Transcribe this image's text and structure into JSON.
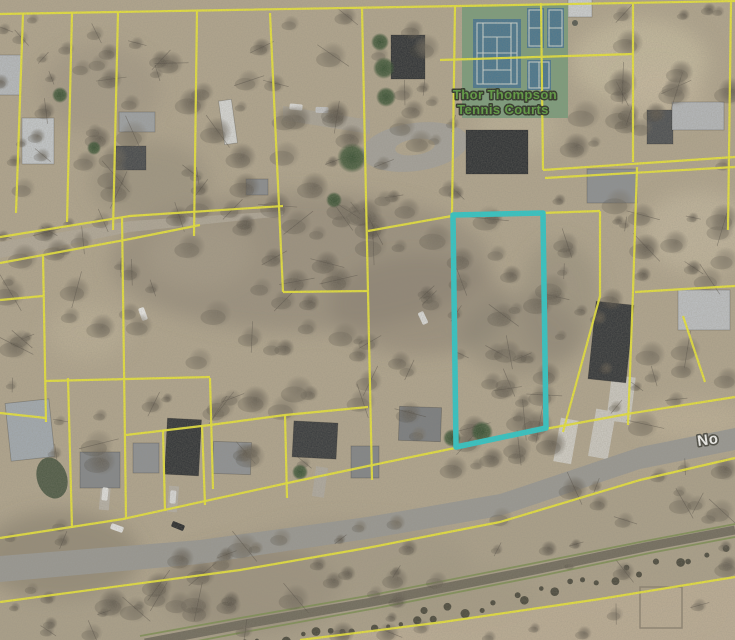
{
  "map": {
    "canvas": {
      "width": 735,
      "height": 640
    },
    "palette": {
      "ground": "#b3a78f",
      "parcel_line": "#eeea35",
      "highlight": "#2acbcb",
      "road": "#9b9a95",
      "rail_green": "#7d9052",
      "rail_bed": "#6c6659",
      "tennis_surface": "#7c9e7c",
      "tennis_court_blue": "#47768f",
      "tennis_label_fill": "#5a9e3c",
      "tennis_label_outline": "#272f21",
      "street_label_fill": "#fbfbf9",
      "street_label_outline": "#46463f"
    },
    "labels": {
      "tennis_facility": {
        "line1": "Thor Thompson",
        "line2": "Tennis Courts"
      },
      "street": {
        "text": "No"
      }
    },
    "highlighted_parcel": {
      "points": "453,215 543,213 546,428 456,447",
      "color": "#2acbcb",
      "width": 5.5
    },
    "parcel_lines": {
      "color": "#eeea35",
      "width": 2.2,
      "segments": [
        "0,14 230,10 460,6 735,1",
        "23,14 16,213",
        "72,13 67,222",
        "118,12 113,230",
        "197,11 194,236",
        "270,13 283,292",
        "362,8 368,292 372,480",
        "455,7 452,213",
        "541,3 543,170",
        "633,4 633,162",
        "731,2 728,230",
        "440,60 633,54",
        "543,170 735,157",
        "545,178 735,167",
        "368,231 452,216 600,211",
        "600,211 600,296 563,432",
        "283,292 368,291",
        "635,292 735,286",
        "637,167 633,292 628,425",
        "683,316 705,382",
        "0,237 130,216 283,206",
        "0,263 130,239 200,225",
        "43,256 46,422",
        "0,413 46,418",
        "68,378 72,528",
        "46,381 210,377",
        "122,217 126,519",
        "210,378 213,489",
        "163,430 165,511",
        "202,425 205,505",
        "285,415 287,498",
        "126,435 210,425 285,415 368,407",
        "0,300 43,296",
        "0,538 123,519 283,484 368,466 455,448 545,429 633,413 735,397",
        "0,602 240,570 367,548 500,522 640,480 735,458",
        "300,640 443,622 600,599 735,577"
      ]
    },
    "roads": {
      "main_polygon": "0,556 200,540 367,517 500,494 640,447 735,428 735,450 640,469 500,516 367,539 200,564 0,582",
      "fill": "#9b9a95",
      "paths": [
        {
          "points": "0,242 130,221 283,211 283,216 130,232 0,258",
          "fill": "#b4ab9c",
          "op": 0.85
        },
        {
          "points": "283,106 370,120 370,134 283,120",
          "fill": "#a9a59d",
          "op": 0.7
        }
      ],
      "loop": {
        "cx": 415,
        "cy": 147,
        "rx": 54,
        "ry": 24,
        "rot": -8,
        "fill": "#a6a39c",
        "island": {
          "rx": 20,
          "ry": 8,
          "fill": "#b3a78f"
        }
      },
      "pads": [
        {
          "x": 566,
          "y": 441,
          "w": 18,
          "h": 44,
          "rot": 10,
          "fill": "#d4d1c9"
        },
        {
          "x": 602,
          "y": 434,
          "w": 20,
          "h": 48,
          "rot": 10,
          "fill": "#cfccc4"
        },
        {
          "x": 621,
          "y": 399,
          "w": 24,
          "h": 46,
          "rot": 7,
          "fill": "#cecbc3"
        },
        {
          "x": 105,
          "y": 496,
          "w": 10,
          "h": 28,
          "rot": 5,
          "fill": "#b9b3a8"
        },
        {
          "x": 173,
          "y": 499,
          "w": 10,
          "h": 26,
          "rot": 5,
          "fill": "#b6b0a5"
        },
        {
          "x": 320,
          "y": 482,
          "w": 12,
          "h": 30,
          "rot": 8,
          "fill": "#b2aca1"
        }
      ]
    },
    "railroad": {
      "corridor_polygon": "0,602 240,570 367,548 500,522 640,480 735,458 735,577 600,599 443,622 300,640 0,640",
      "corridor_fill": "#a89d88",
      "field_polygon": "300,640 443,622 600,599 735,577 735,640",
      "field_fill": "#c0b298",
      "bed_points": "145,643 245,624 372,602 535,570 645,547 735,530",
      "green_lines": [
        "140,636 240,618 367,596 530,564 640,542 735,524",
        "150,650 250,631 377,608 540,576 650,553 735,537"
      ],
      "shrub_baseline": "195,655 300,638 420,616 540,592 640,570 735,550",
      "shrub_fill": "#3a382e",
      "fence_square": {
        "x": 640,
        "y": 587,
        "w": 42,
        "h": 41,
        "stroke": "#8a7f6d"
      }
    },
    "tennis_courts": {
      "surface": {
        "x": 462,
        "y": 5,
        "w": 106,
        "h": 113,
        "fill": "#7c9e7c"
      },
      "courts": [
        {
          "x": 473,
          "y": 19,
          "w": 48,
          "h": 69
        },
        {
          "x": 527,
          "y": 8,
          "w": 17,
          "h": 40
        },
        {
          "x": 547,
          "y": 8,
          "w": 17,
          "h": 40
        },
        {
          "x": 527,
          "y": 60,
          "w": 24,
          "h": 30
        }
      ],
      "court_fill": "#47768f",
      "white_rects": [
        {
          "x": 477,
          "y": 23,
          "w": 40,
          "h": 61
        },
        {
          "x": 529,
          "y": 10,
          "w": 13,
          "h": 36
        },
        {
          "x": 549,
          "y": 10,
          "w": 13,
          "h": 36
        },
        {
          "x": 529,
          "y": 62,
          "w": 20,
          "h": 26
        }
      ],
      "white_lines": [
        {
          "x1": 483,
          "y1": 23,
          "x2": 483,
          "y2": 84
        },
        {
          "x1": 511,
          "y1": 23,
          "x2": 511,
          "y2": 84
        },
        {
          "x1": 483,
          "y1": 37,
          "x2": 511,
          "y2": 37
        },
        {
          "x1": 483,
          "y1": 70,
          "x2": 511,
          "y2": 70
        },
        {
          "x1": 497,
          "y1": 37,
          "x2": 497,
          "y2": 70
        },
        {
          "x1": 477,
          "y1": 53,
          "x2": 517,
          "y2": 53
        },
        {
          "x1": 529,
          "y1": 28,
          "x2": 542,
          "y2": 28
        },
        {
          "x1": 549,
          "y1": 28,
          "x2": 562,
          "y2": 28
        },
        {
          "x1": 539,
          "y1": 62,
          "x2": 539,
          "y2": 88
        }
      ]
    },
    "buildings": [
      {
        "x": 10,
        "y": 75,
        "w": 22,
        "h": 40,
        "rot": 0,
        "fill": "#b9bdc1"
      },
      {
        "x": 38,
        "y": 141,
        "w": 32,
        "h": 46,
        "rot": 0,
        "fill": "#c7cbce"
      },
      {
        "x": 137,
        "y": 122,
        "w": 36,
        "h": 20,
        "rot": 0,
        "fill": "#9fa3a6"
      },
      {
        "x": 131,
        "y": 158,
        "w": 30,
        "h": 24,
        "rot": 0,
        "fill": "#45484b"
      },
      {
        "x": 228,
        "y": 122,
        "w": 13,
        "h": 44,
        "rot": -8,
        "fill": "#dadbd9"
      },
      {
        "x": 257,
        "y": 187,
        "w": 22,
        "h": 16,
        "rot": 0,
        "fill": "#8b8e91"
      },
      {
        "x": 408,
        "y": 57,
        "w": 34,
        "h": 44,
        "rot": 0,
        "fill": "#2e3134"
      },
      {
        "x": 497,
        "y": 152,
        "w": 62,
        "h": 44,
        "rot": 0,
        "fill": "#2b2e31"
      },
      {
        "x": 612,
        "y": 186,
        "w": 50,
        "h": 34,
        "rot": 0,
        "fill": "#8e9194"
      },
      {
        "x": 660,
        "y": 127,
        "w": 26,
        "h": 34,
        "rot": 0,
        "fill": "#4b4e51"
      },
      {
        "x": 698,
        "y": 116,
        "w": 52,
        "h": 28,
        "rot": 0,
        "fill": "#b7babd"
      },
      {
        "x": 580,
        "y": 8,
        "w": 24,
        "h": 18,
        "rot": 0,
        "fill": "#cfd2d4"
      },
      {
        "x": 704,
        "y": 310,
        "w": 52,
        "h": 40,
        "rot": 0,
        "fill": "#c0c3c6"
      },
      {
        "x": 611,
        "y": 342,
        "w": 38,
        "h": 78,
        "rot": 6,
        "fill": "#303336"
      },
      {
        "x": 30,
        "y": 430,
        "w": 44,
        "h": 58,
        "rot": -6,
        "fill": "#a4acb3"
      },
      {
        "x": 100,
        "y": 470,
        "w": 40,
        "h": 36,
        "rot": 0,
        "fill": "#85888b"
      },
      {
        "x": 146,
        "y": 458,
        "w": 26,
        "h": 30,
        "rot": 0,
        "fill": "#8f9295"
      },
      {
        "x": 183,
        "y": 447,
        "w": 34,
        "h": 56,
        "rot": 3,
        "fill": "#2e3134"
      },
      {
        "x": 232,
        "y": 458,
        "w": 38,
        "h": 32,
        "rot": 2,
        "fill": "#909396"
      },
      {
        "x": 315,
        "y": 440,
        "w": 44,
        "h": 36,
        "rot": 3,
        "fill": "#35383b"
      },
      {
        "x": 365,
        "y": 462,
        "w": 28,
        "h": 32,
        "rot": 0,
        "fill": "#838689"
      },
      {
        "x": 420,
        "y": 424,
        "w": 42,
        "h": 34,
        "rot": 2,
        "fill": "#7b7e81"
      }
    ],
    "vehicles": [
      {
        "x": 117,
        "y": 528,
        "rot": -70,
        "fill": "#e8e8e6"
      },
      {
        "x": 178,
        "y": 526,
        "rot": -68,
        "fill": "#26282a"
      },
      {
        "x": 105,
        "y": 494,
        "rot": 6,
        "fill": "#e6e6e4"
      },
      {
        "x": 173,
        "y": 497,
        "rot": 4,
        "fill": "#dededd"
      },
      {
        "x": 296,
        "y": 107,
        "rot": 96,
        "fill": "#e2e2e0"
      },
      {
        "x": 322,
        "y": 110,
        "rot": 92,
        "fill": "#c6c7c8"
      },
      {
        "x": 143,
        "y": 314,
        "rot": -20,
        "fill": "#eeeeec"
      },
      {
        "x": 423,
        "y": 318,
        "rot": -25,
        "fill": "#dcdcda"
      }
    ],
    "vegetation": {
      "zones": [
        {
          "x": 0,
          "y": 18,
          "w": 265,
          "h": 195,
          "count": 42
        },
        {
          "x": 268,
          "y": 15,
          "w": 190,
          "h": 195,
          "count": 30
        },
        {
          "x": 545,
          "y": 8,
          "w": 190,
          "h": 150,
          "count": 22
        },
        {
          "x": 0,
          "y": 205,
          "w": 460,
          "h": 95,
          "count": 40
        },
        {
          "x": 0,
          "y": 298,
          "w": 560,
          "h": 165,
          "count": 58
        },
        {
          "x": 545,
          "y": 160,
          "w": 190,
          "h": 265,
          "count": 34
        },
        {
          "x": 0,
          "y": 520,
          "w": 400,
          "h": 120,
          "count": 46
        },
        {
          "x": 380,
          "y": 455,
          "w": 355,
          "h": 185,
          "count": 40
        },
        {
          "x": 455,
          "y": 215,
          "w": 90,
          "h": 230,
          "count": 18
        }
      ],
      "evergreens": [
        [
          352,
          158,
          15
        ],
        [
          380,
          42,
          9
        ],
        [
          384,
          68,
          11
        ],
        [
          386,
          97,
          10
        ],
        [
          452,
          438,
          9
        ],
        [
          482,
          432,
          11
        ],
        [
          334,
          200,
          8
        ],
        [
          300,
          472,
          8
        ],
        [
          94,
          148,
          7
        ],
        [
          60,
          95,
          8
        ]
      ],
      "pond": {
        "cx": 52,
        "cy": 478,
        "rx": 15,
        "ry": 21,
        "rot": -18,
        "fill": "#42523d"
      }
    },
    "ground": {
      "base": "#b3a78f",
      "patches": [
        {
          "x": 640,
          "y": 62,
          "rx": 68,
          "ry": 42,
          "fill": "#cbbfa3",
          "op": 0.8
        },
        {
          "x": 698,
          "y": 232,
          "rx": 55,
          "ry": 40,
          "fill": "#c6baa0",
          "op": 0.8
        },
        {
          "x": 200,
          "y": 253,
          "rx": 52,
          "ry": 34,
          "fill": "#c4b89e",
          "op": 0.7
        },
        {
          "x": 88,
          "y": 332,
          "rx": 40,
          "ry": 28,
          "fill": "#c1b59b",
          "op": 0.6
        },
        {
          "x": 518,
          "y": 128,
          "rx": 42,
          "ry": 26,
          "fill": "#c3b79d",
          "op": 0.6
        },
        {
          "x": 300,
          "y": 262,
          "rx": 190,
          "ry": 70,
          "fill": "#857c6e",
          "op": 0.45
        },
        {
          "x": 420,
          "y": 305,
          "rx": 90,
          "ry": 50,
          "fill": "#7f7668",
          "op": 0.4
        },
        {
          "x": 150,
          "y": 182,
          "rx": 60,
          "ry": 40,
          "fill": "#8a8173",
          "op": 0.4
        },
        {
          "x": 60,
          "y": 556,
          "rx": 80,
          "ry": 45,
          "fill": "#6f675b",
          "op": 0.4
        },
        {
          "x": 250,
          "y": 588,
          "rx": 90,
          "ry": 45,
          "fill": "#6d655a",
          "op": 0.4
        },
        {
          "x": 520,
          "y": 335,
          "rx": 60,
          "ry": 40,
          "fill": "#837a6c",
          "op": 0.4
        },
        {
          "x": 660,
          "y": 95,
          "rx": 45,
          "ry": 30,
          "fill": "#c9bda1",
          "op": 0.6
        },
        {
          "x": 690,
          "y": 420,
          "rx": 55,
          "ry": 20,
          "fill": "#c2b498",
          "op": 0.8
        },
        {
          "x": 560,
          "y": 300,
          "rx": 40,
          "ry": 60,
          "fill": "#877e70",
          "op": 0.35
        },
        {
          "x": 100,
          "y": 90,
          "rx": 60,
          "ry": 45,
          "fill": "#948b7c",
          "op": 0.35
        },
        {
          "x": 350,
          "y": 560,
          "rx": 120,
          "ry": 40,
          "fill": "#998f7e",
          "op": 0.4
        },
        {
          "x": 620,
          "y": 600,
          "rx": 90,
          "ry": 35,
          "fill": "#b4a78d",
          "op": 0.6
        },
        {
          "x": 460,
          "y": 600,
          "rx": 80,
          "ry": 35,
          "fill": "#a2977f",
          "op": 0.5
        }
      ]
    }
  }
}
